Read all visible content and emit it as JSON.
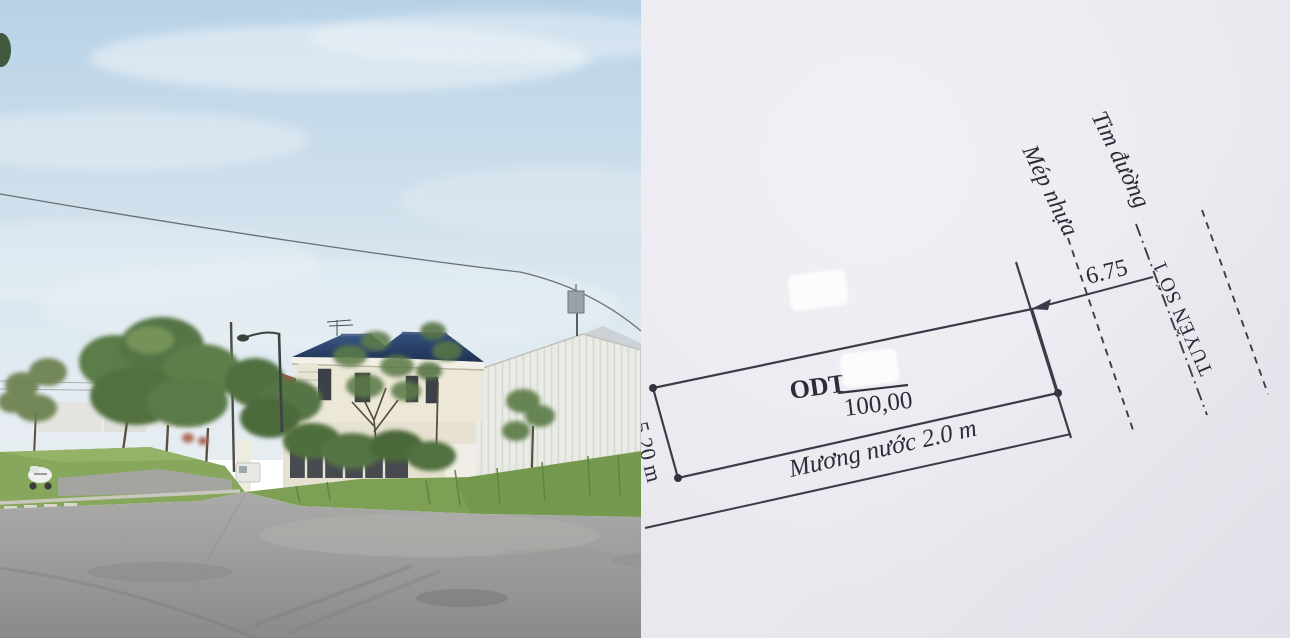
{
  "page": {
    "title": "Real-estate listing: street photo beside cadastral plot sketch"
  },
  "photo": {
    "description": "Suburban corner lot: two-storey cream house with navy hip roof, white corrugated warehouse wall, green trees, grass verge, empty asphalt intersection, power line across hazy blue sky, parked white scooter, street lamp and telecom antenna",
    "colors": {
      "sky_top": "#b7d2e8",
      "sky_horizon": "#e6edf2",
      "roof_navy": "#2c4870",
      "house_wall": "#ece7d7",
      "warehouse_wall": "#e9eae5",
      "tree_green": "#5c7c48",
      "grass": "#87a75d",
      "road": "#9c9d9c",
      "red_roof": "#a85843"
    }
  },
  "sketch": {
    "type": "cadastral parcel sketch",
    "labels": {
      "road_centerline": "Tim đường",
      "asphalt_edge": "Mép nhựa",
      "route_name": "TUYẾN SỐ 1",
      "distance_to_centerline_m": "6.75",
      "land_use_code": "ODT",
      "area_m2": "100,00",
      "water_ditch": "Mương nước 2.0 m",
      "side_edge_length_m": "5.20 m"
    },
    "redaction_boxes": 2,
    "colors": {
      "paper": "#e8e8ee",
      "ink": "#3b3c49"
    }
  }
}
